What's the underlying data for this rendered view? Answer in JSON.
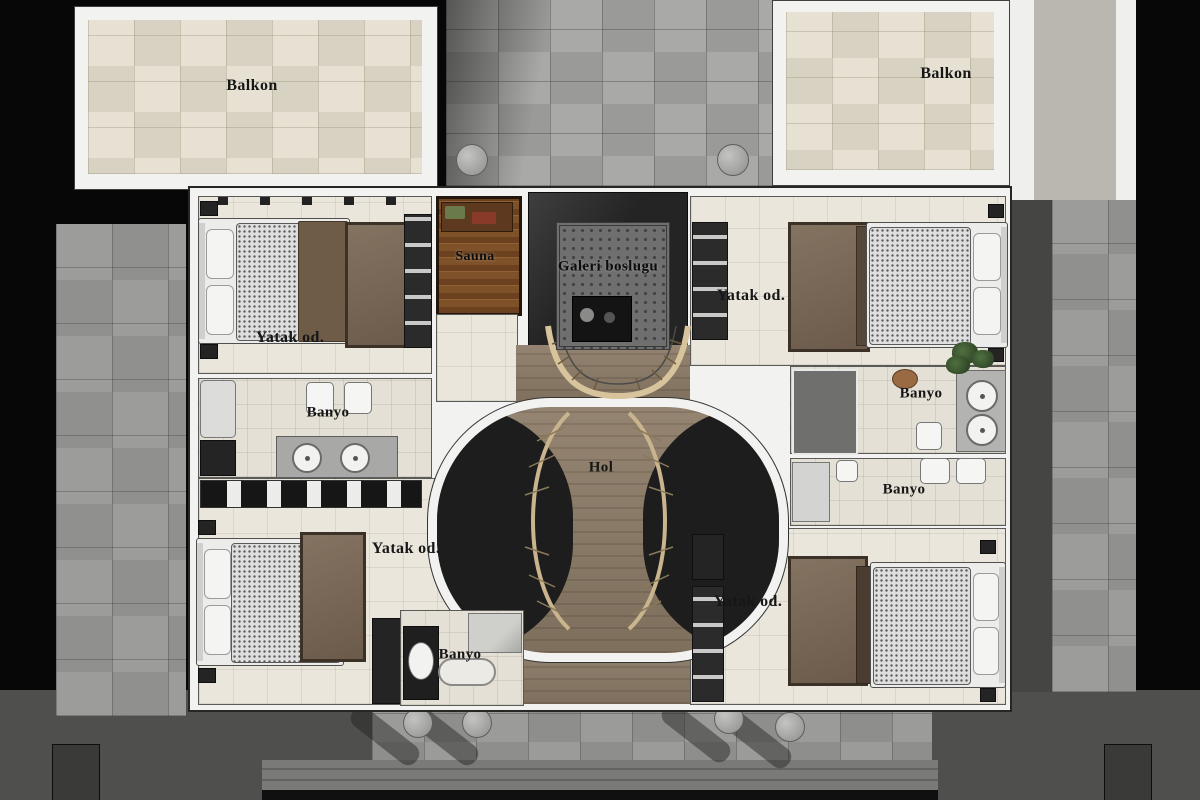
{
  "plan": {
    "type": "residential-floor-plan",
    "balconies": [
      {
        "label": "Balkon"
      },
      {
        "label": "Balkon"
      }
    ],
    "rooms": {
      "sauna": "Sauna",
      "gallery_void": "Galeri boslugu",
      "hall": "Hol",
      "bedroom_top_left": "Yatak od.",
      "bedroom_top_right": "Yatak od.",
      "bedroom_bottom_left": "Yatak od.",
      "bedroom_bottom_right": "Yatak od.",
      "bathroom_left": "Banyo",
      "bathroom_right_upper": "Banyo",
      "bathroom_right_lower": "Banyo",
      "bathroom_bottom": "Banyo"
    },
    "colors": {
      "background": "#070707",
      "terrace_tile": "#9a9a98",
      "balcony_tile": "#d8d2c2",
      "interior_floor": "#eae6db",
      "hall_wood": "#8d7c68",
      "sauna_wood": "#7c4f2a",
      "gallery_void_floor": "#242424",
      "rug_brown": "#7a6754",
      "wall_white": "#f2f2f0"
    }
  }
}
